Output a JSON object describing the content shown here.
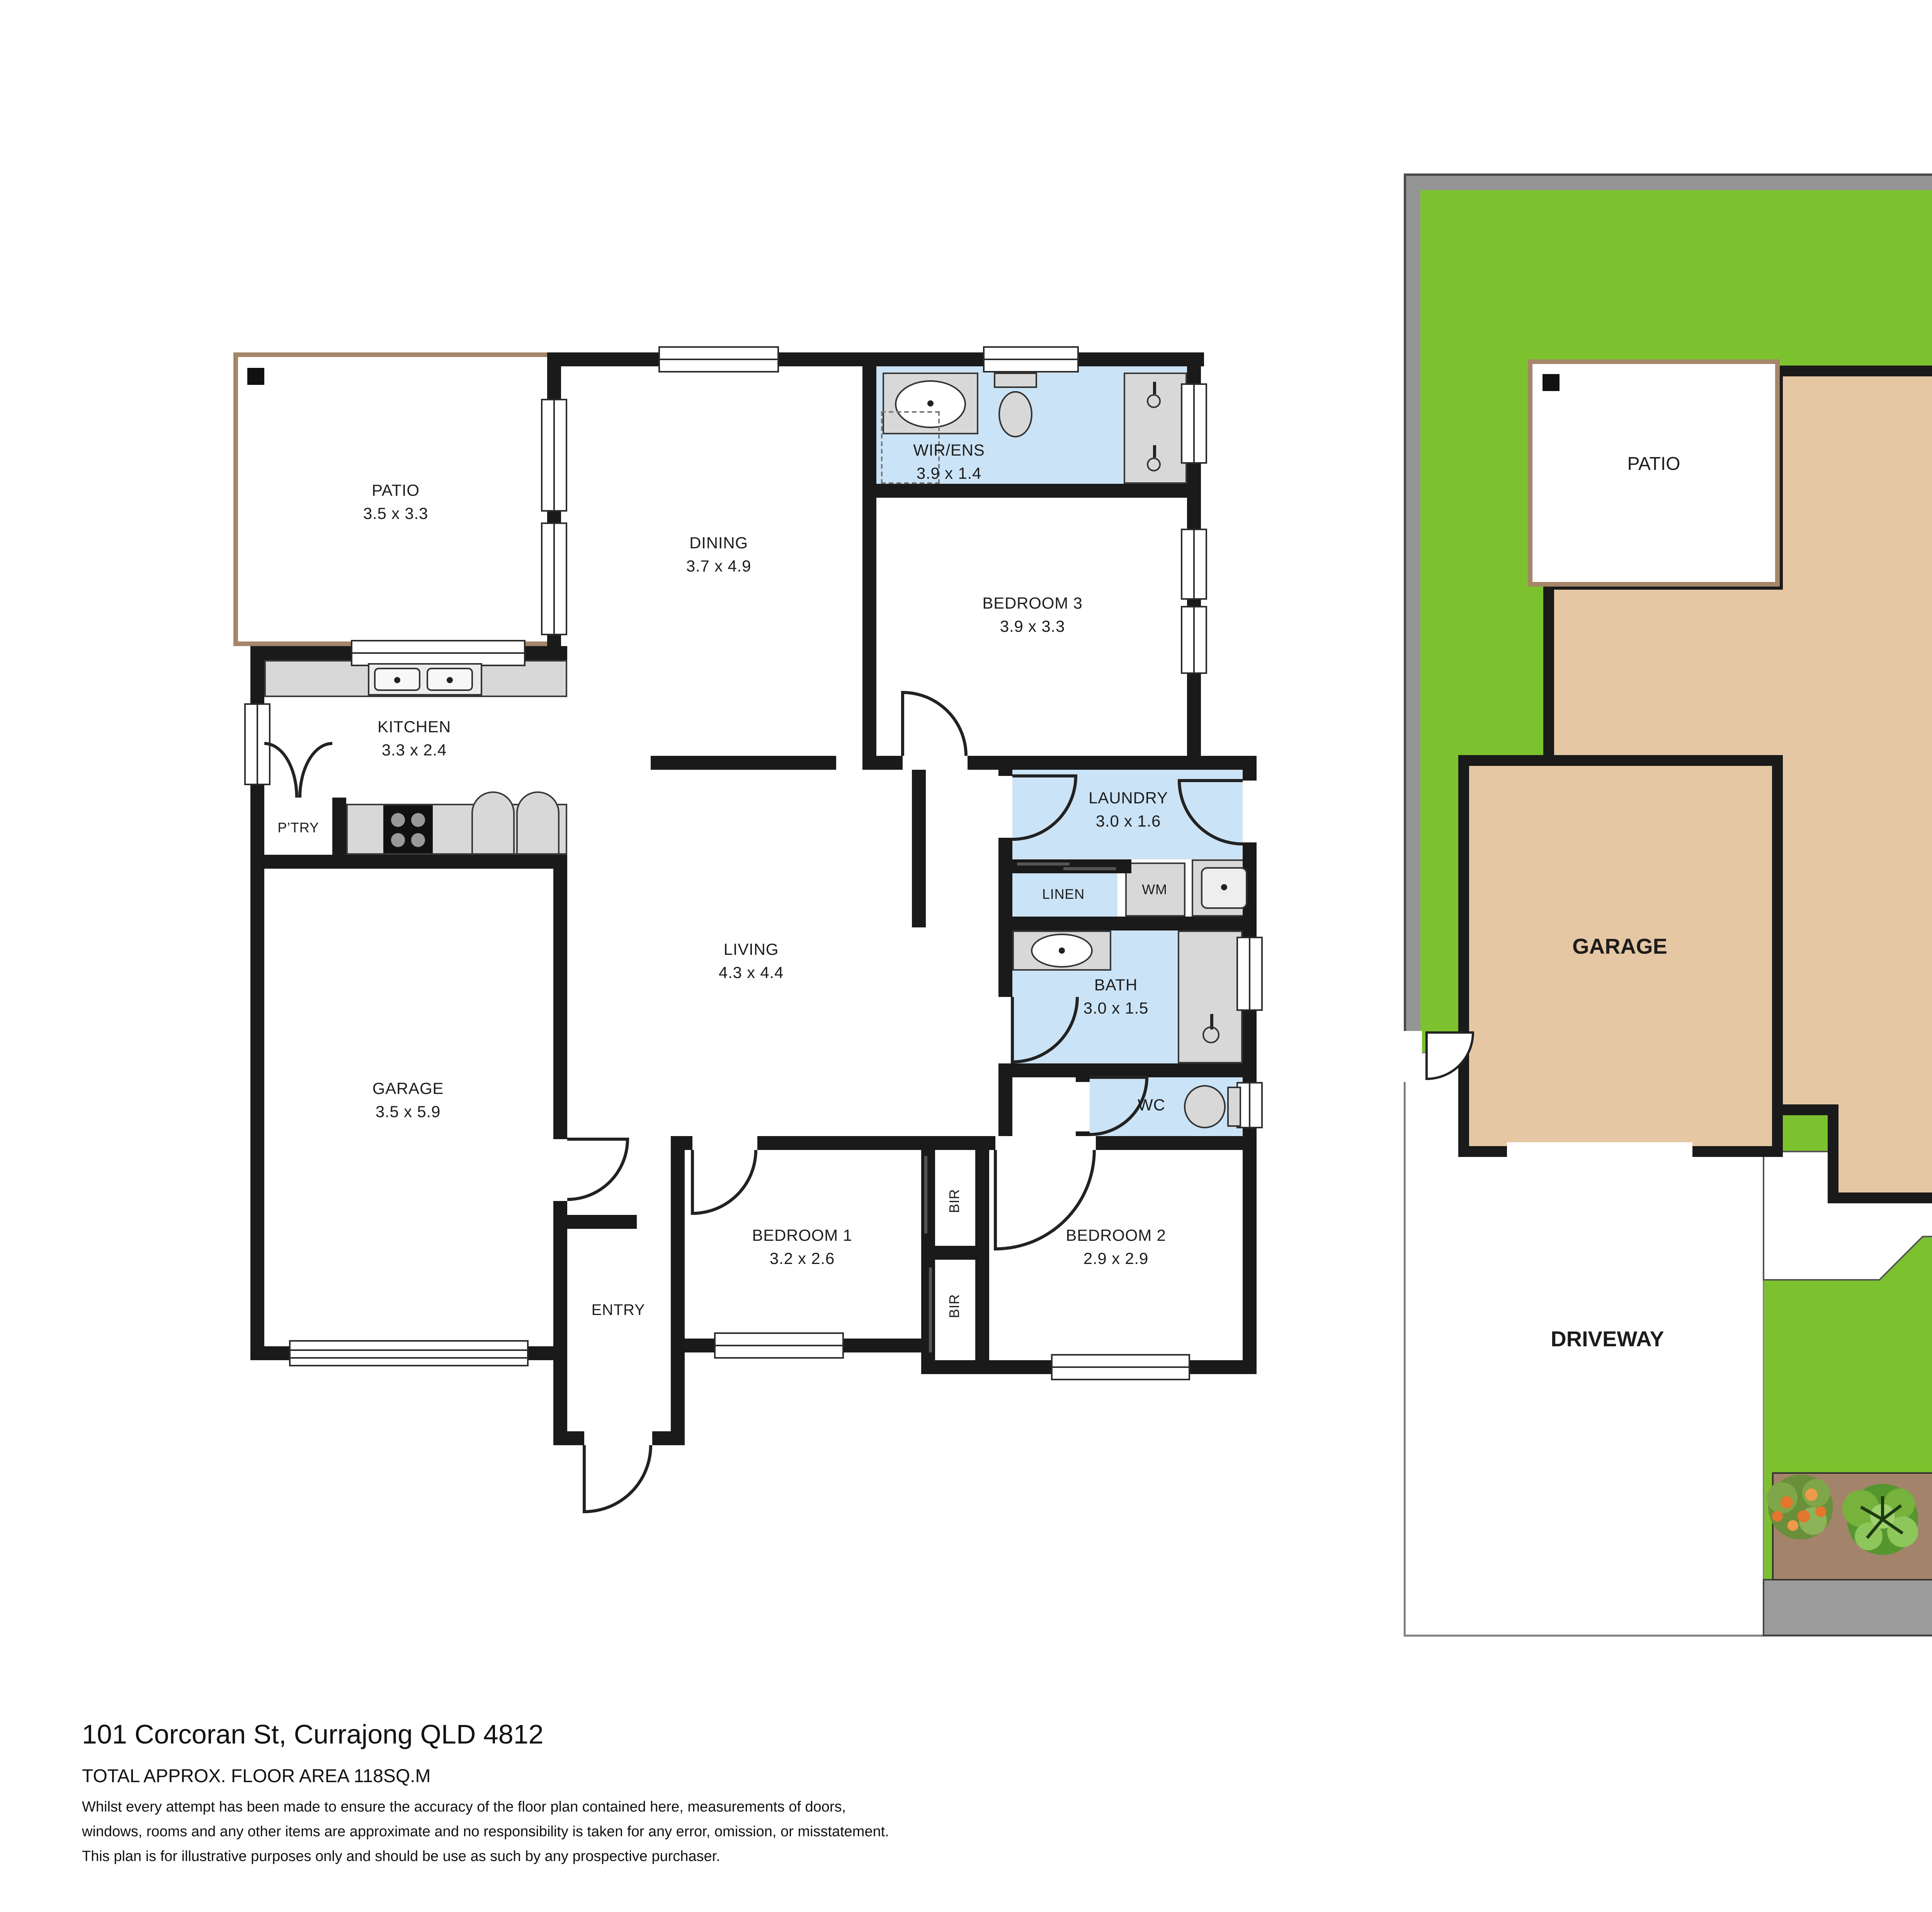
{
  "floor_plan": {
    "rooms": {
      "patio": {
        "name": "PATIO",
        "dims": "3.5 x 3.3"
      },
      "dining": {
        "name": "DINING",
        "dims": "3.7 x 4.9"
      },
      "wir_ens": {
        "name": "WIR/ENS",
        "dims": "3.9 x 1.4"
      },
      "bedroom3": {
        "name": "BEDROOM 3",
        "dims": "3.9 x 3.3"
      },
      "kitchen": {
        "name": "KITCHEN",
        "dims": "3.3 x 2.4"
      },
      "pantry": {
        "name": "P’TRY"
      },
      "laundry": {
        "name": "LAUNDRY",
        "dims": "3.0 x 1.6"
      },
      "linen": {
        "name": "LINEN"
      },
      "wm": {
        "name": "WM"
      },
      "living": {
        "name": "LIVING",
        "dims": "4.3 x 4.4"
      },
      "bath": {
        "name": "BATH",
        "dims": "3.0 x 1.5"
      },
      "garage": {
        "name": "GARAGE",
        "dims": "3.5 x 5.9"
      },
      "wc": {
        "name": "WC"
      },
      "bedroom1": {
        "name": "BEDROOM 1",
        "dims": "3.2 x 2.6"
      },
      "bedroom2": {
        "name": "BEDROOM 2",
        "dims": "2.9 x 2.9"
      },
      "entry": {
        "name": "ENTRY"
      },
      "bir_top": {
        "name": "BIR"
      },
      "bir_bottom": {
        "name": "BIR"
      }
    }
  },
  "site_plan": {
    "labels": {
      "patio": "PATIO",
      "residence": "RESIDENCE",
      "garage": "GARAGE",
      "driveway": "DRIVEWAY"
    }
  },
  "footer": {
    "address": "101 Corcoran St, Currajong QLD 4812",
    "floor_area": "TOTAL APPROX. FLOOR AREA 118SQ.M",
    "disclaimer_line1": "Whilst every attempt has been made to ensure the accuracy of the floor plan contained here, measurements of doors,",
    "disclaimer_line2": "windows, rooms and any other items are approximate and no responsibility is taken for any error, omission, or misstatement.",
    "disclaimer_line3": "This plan is for illustrative purposes only and should be use as such by any prospective purchaser."
  },
  "colors": {
    "wet_area": "#cbe3f6",
    "walls": "#1a1a1a",
    "fixture_gray": "#d8d8d8",
    "lawn": "#7cc22e",
    "residence_fill": "#e6c7a4",
    "boundary_gray": "#959595",
    "patio_border_brown": "#a5866a",
    "garden_soil": "#a3846b"
  }
}
